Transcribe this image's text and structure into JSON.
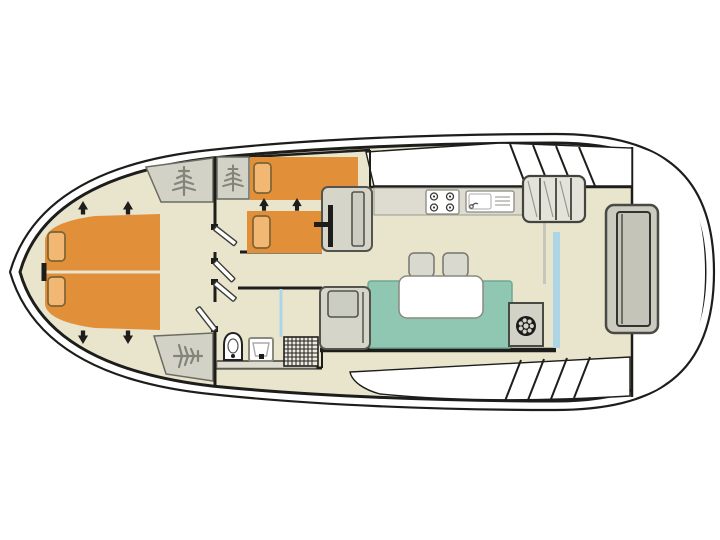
{
  "diagram": {
    "type": "boat-floor-plan",
    "label": "Boat deck floor plan",
    "rooms": [
      {
        "name": "bow-cabin",
        "furniture": [
          "double-bed",
          "pillow",
          "pillow",
          "wardrobe",
          "wardrobe",
          "widening-arrows"
        ]
      },
      {
        "name": "middle-cabin",
        "furniture": [
          "single-bed",
          "single-bed",
          "pillow",
          "pillow",
          "wardrobe",
          "cabinet",
          "widening-arrows"
        ]
      },
      {
        "name": "vestibule",
        "furniture": [
          "door",
          "door",
          "door",
          "door"
        ]
      },
      {
        "name": "bathroom",
        "furniture": [
          "toilet",
          "washbasin",
          "shower-tray",
          "shower-screen",
          "ledge"
        ]
      },
      {
        "name": "galley",
        "furniture": [
          "worktop",
          "hob-4-burners",
          "sink-with-drainer"
        ]
      },
      {
        "name": "saloon",
        "furniture": [
          "l-sofa",
          "table",
          "stool",
          "stool",
          "bench-seat",
          "helm-console",
          "helm-wheel"
        ]
      },
      {
        "name": "aft-deck",
        "furniture": [
          "companionway-stairs",
          "stern-bench",
          "side-deck-steps"
        ]
      }
    ],
    "icons": [
      "wardrobe-icon",
      "helm-wheel-icon",
      "hob-icon",
      "sink-icon",
      "toilet-icon",
      "washbasin-icon",
      "shower-grid-icon",
      "door-swing-icon",
      "direction-arrow-icon",
      "stairs-icon"
    ]
  },
  "colors": {
    "wall": "#1d1d1b",
    "floor": "#e9e5cd",
    "orange": "#e28f3a",
    "pillow": "#f2b873",
    "pillow_line": "#7c6335",
    "teal": "#8fc7b3",
    "teal_line": "#6fa893",
    "gray_fill": "#d5d5ca",
    "gray_line": "#54544d",
    "counter": "#dedcd1",
    "wardrobe": "#d2d2c7",
    "icon": "#84847a",
    "blue": "#aed5e6",
    "deck": "#ffffff"
  }
}
